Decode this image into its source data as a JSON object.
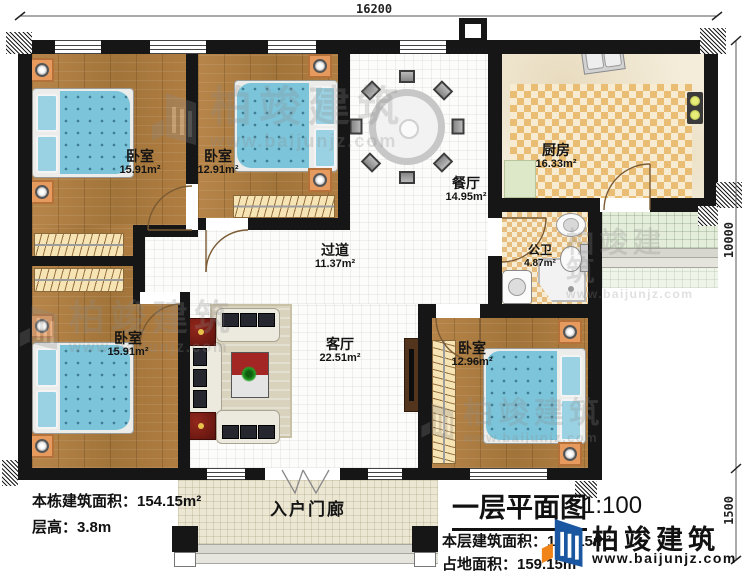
{
  "plan": {
    "title": "一层平面图",
    "scale": "1:100"
  },
  "dimensions": {
    "width_top": "16200",
    "height_main": "10000",
    "height_porch": "1500"
  },
  "rooms": {
    "bedroom_tl": {
      "name": "卧室",
      "area": "15.91m²"
    },
    "bedroom_tm": {
      "name": "卧室",
      "area": "12.91m²"
    },
    "dining": {
      "name": "餐厅",
      "area": "14.95m²"
    },
    "kitchen": {
      "name": "厨房",
      "area": "16.33m²"
    },
    "bathroom": {
      "name": "公卫",
      "area": "4.87m²"
    },
    "corridor": {
      "name": "过道",
      "area": "11.37m²"
    },
    "living": {
      "name": "客厅",
      "area": "22.51m²"
    },
    "bedroom_bl": {
      "name": "卧室",
      "area": "15.91m²"
    },
    "bedroom_br": {
      "name": "卧室",
      "area": "12.96m²"
    },
    "porch": {
      "name": "入户门廊"
    }
  },
  "info_left": {
    "building_area": "本栋建筑面积：154.15m²",
    "floor_height": "层高：3.8m"
  },
  "title_block": {
    "title": "一层平面图",
    "scale": "1:100",
    "floor_area": "本层建筑面积：154.15m²",
    "land_area": "占地面积：159.15m²"
  },
  "brand": {
    "name": "柏竣建筑",
    "url": "www.baijunjz.com"
  },
  "watermark": {
    "name": "柏竣建筑",
    "url": "www.baijunjz.com"
  },
  "colors": {
    "wall": "#161616",
    "wood_floor": "#aa7a3e",
    "bed_blue": "#7cc4da",
    "kitchen_checker": "#e9bd74",
    "brand_blue": "#1a57a0",
    "brand_orange": "#f08419"
  }
}
